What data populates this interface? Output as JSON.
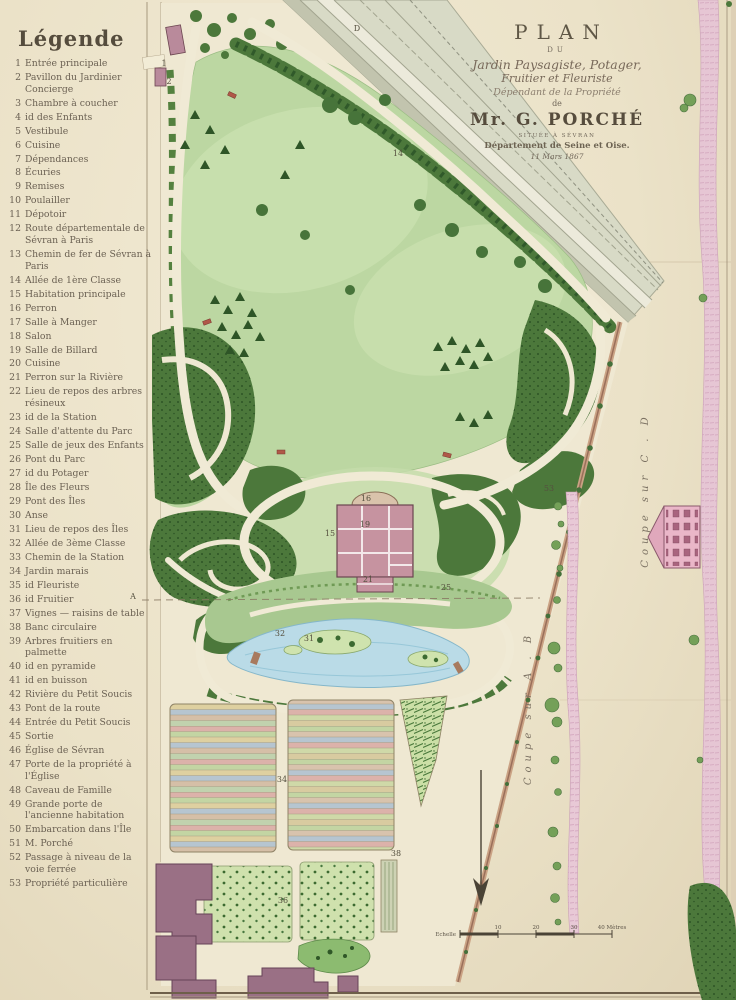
{
  "legend": {
    "heading": "Légende",
    "items": [
      {
        "num": "1",
        "label": "Entrée principale"
      },
      {
        "num": "2",
        "label": "Pavillon du Jardinier Concierge"
      },
      {
        "num": "3",
        "label": "Chambre à coucher"
      },
      {
        "num": "4",
        "label": "id des Enfants"
      },
      {
        "num": "5",
        "label": "Vestibule"
      },
      {
        "num": "6",
        "label": "Cuisine"
      },
      {
        "num": "7",
        "label": "Dépendances"
      },
      {
        "num": "8",
        "label": "Écuries"
      },
      {
        "num": "9",
        "label": "Remises"
      },
      {
        "num": "10",
        "label": "Poulailler"
      },
      {
        "num": "11",
        "label": "Dépotoir"
      },
      {
        "num": "12",
        "label": "Route départementale de Sévran à Paris"
      },
      {
        "num": "13",
        "label": "Chemin de fer de Sévran à Paris"
      },
      {
        "num": "14",
        "label": "Allée de 1ère Classe"
      },
      {
        "num": "15",
        "label": "Habitation principale"
      },
      {
        "num": "16",
        "label": "Perron"
      },
      {
        "num": "17",
        "label": "Salle à Manger"
      },
      {
        "num": "18",
        "label": "Salon"
      },
      {
        "num": "19",
        "label": "Salle de Billard"
      },
      {
        "num": "20",
        "label": "Cuisine"
      },
      {
        "num": "21",
        "label": "Perron sur la Rivière"
      },
      {
        "num": "22",
        "label": "Lieu de repos des arbres résineux"
      },
      {
        "num": "23",
        "label": "id de la Station"
      },
      {
        "num": "24",
        "label": "Salle d'attente du Parc"
      },
      {
        "num": "25",
        "label": "Salle de jeux des Enfants"
      },
      {
        "num": "26",
        "label": "Pont du Parc"
      },
      {
        "num": "27",
        "label": "id du Potager"
      },
      {
        "num": "28",
        "label": "Île des Fleurs"
      },
      {
        "num": "29",
        "label": "Pont des Îles"
      },
      {
        "num": "30",
        "label": "Anse"
      },
      {
        "num": "31",
        "label": "Lieu de repos des Îles"
      },
      {
        "num": "32",
        "label": "Allée de 3ème Classe"
      },
      {
        "num": "33",
        "label": "Chemin de la Station"
      },
      {
        "num": "34",
        "label": "Jardin marais"
      },
      {
        "num": "35",
        "label": "id Fleuriste"
      },
      {
        "num": "36",
        "label": "id Fruitier"
      },
      {
        "num": "37",
        "label": "Vignes — raisins de table"
      },
      {
        "num": "38",
        "label": "Banc circulaire"
      },
      {
        "num": "39",
        "label": "Arbres fruitiers en palmette"
      },
      {
        "num": "40",
        "label": "id en pyramide"
      },
      {
        "num": "41",
        "label": "id en buisson"
      },
      {
        "num": "42",
        "label": "Rivière du Petit Soucis"
      },
      {
        "num": "43",
        "label": "Pont de la route"
      },
      {
        "num": "44",
        "label": "Entrée du Petit Soucis"
      },
      {
        "num": "45",
        "label": "Sortie"
      },
      {
        "num": "46",
        "label": "Église de Sévran"
      },
      {
        "num": "47",
        "label": "Porte de la propriété à l'Église"
      },
      {
        "num": "48",
        "label": "Caveau de Famille"
      },
      {
        "num": "49",
        "label": "Grande porte de l'ancienne habitation"
      },
      {
        "num": "50",
        "label": "Embarcation dans l'Île"
      },
      {
        "num": "51",
        "label": "M. Porché"
      },
      {
        "num": "52",
        "label": "Passage à niveau de la voie ferrée"
      },
      {
        "num": "53",
        "label": "Propriété particulière"
      }
    ]
  },
  "title_block": {
    "plan": "PLAN",
    "du": "DU",
    "garden_line": "Jardin Paysagiste, Potager,",
    "fruit_line": "Fruitier et Fleuriste",
    "depend_line": "Dépendant de la Propriété",
    "de": "de",
    "owner": "Mr. G. PORCHÉ",
    "situated": "SITUÉE À SÉVRAN",
    "department": "Département de Seine et Oise.",
    "date": "11 Mars 1867"
  },
  "sections": {
    "ab": "Coupe sur A . B",
    "cd": "Coupe sur C . D"
  },
  "scale_bar": {
    "label": "Echelle",
    "ticks": [
      "10",
      "20",
      "30",
      "40 Mètres"
    ]
  },
  "map_labels": [
    {
      "x": 357,
      "y": 31,
      "t": "D"
    },
    {
      "x": 164,
      "y": 66,
      "t": "1"
    },
    {
      "x": 169,
      "y": 84,
      "t": "2"
    },
    {
      "x": 398,
      "y": 156,
      "t": "14"
    },
    {
      "x": 330,
      "y": 536,
      "t": "15"
    },
    {
      "x": 366,
      "y": 501,
      "t": "16"
    },
    {
      "x": 365,
      "y": 527,
      "t": "19"
    },
    {
      "x": 368,
      "y": 582,
      "t": "21"
    },
    {
      "x": 446,
      "y": 590,
      "t": "25"
    },
    {
      "x": 309,
      "y": 641,
      "t": "31"
    },
    {
      "x": 280,
      "y": 636,
      "t": "32"
    },
    {
      "x": 282,
      "y": 782,
      "t": "34"
    },
    {
      "x": 283,
      "y": 903,
      "t": "36"
    },
    {
      "x": 396,
      "y": 856,
      "t": "38"
    },
    {
      "x": 549,
      "y": 491,
      "t": "53"
    },
    {
      "x": 133,
      "y": 599,
      "t": "A"
    }
  ],
  "colors": {
    "paper": "#ebe2c8",
    "lawn": "#bcd7a2",
    "woods": "#4c783b",
    "water": "#badbe7",
    "house_pink": "#c693a0",
    "building_mauve": "#9a7085",
    "section_pink": "#e8c9d6",
    "ink": "#6b6153"
  }
}
